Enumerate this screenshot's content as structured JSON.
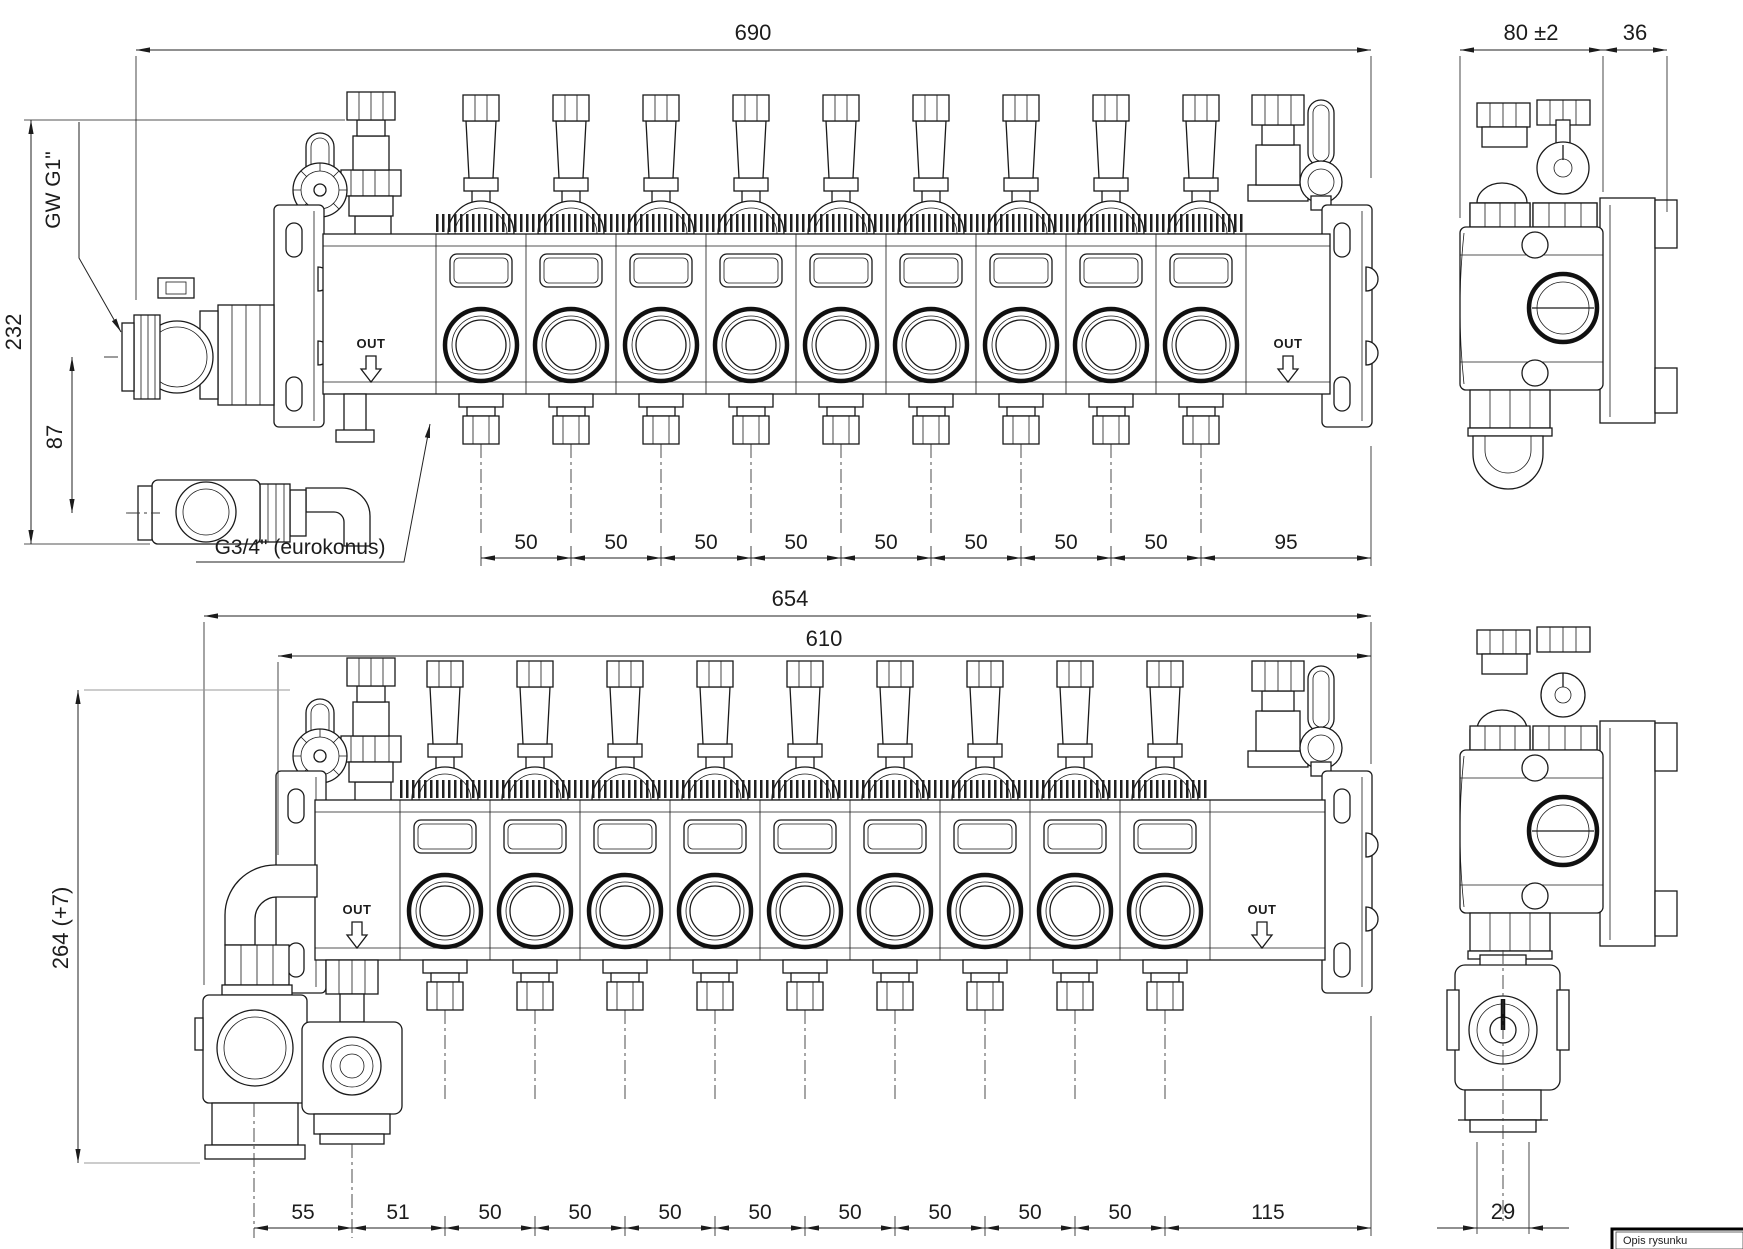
{
  "top_view": {
    "dim_overall_width": "690",
    "dim_overall_height": "232",
    "dim_inlet_offset": "87",
    "label_inlet_thread": "GW G1\"",
    "label_outlet_thread": "G3/4\" (eurokonus)",
    "label_out_left": "OUT",
    "label_out_right": "OUT",
    "spacings": [
      "50",
      "50",
      "50",
      "50",
      "50",
      "50",
      "50",
      "50",
      "95"
    ]
  },
  "top_side_view": {
    "dim_depth": "80 ±2",
    "dim_bracket_offset": "36"
  },
  "bottom_view": {
    "dim_overall_width": "654",
    "dim_mount_width": "610",
    "dim_overall_height": "264 (+7)",
    "label_out_left": "OUT",
    "label_out_right": "OUT",
    "spacings": [
      "55",
      "51",
      "50",
      "50",
      "50",
      "50",
      "50",
      "50",
      "50",
      "50",
      "115"
    ]
  },
  "bottom_side_view": {
    "dim_valve_offset": "29"
  },
  "title_block": {
    "label": "Opis rysunku"
  }
}
